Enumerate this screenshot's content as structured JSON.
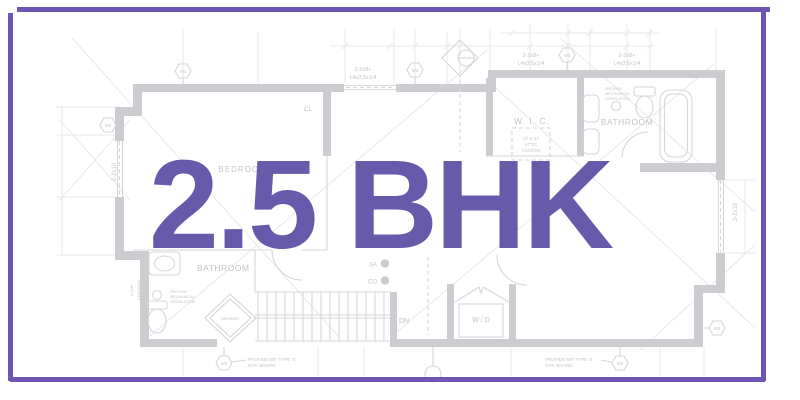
{
  "title": {
    "text": "2.5 BHK",
    "color": "#675AAB"
  },
  "frame": {
    "color": "#6F55B6"
  },
  "floor_plan": {
    "colors": {
      "wall": "#cccdd1",
      "line": "#d6d7db",
      "faint": "#e8e9ed",
      "text": "#c3c4ca"
    },
    "rooms": {
      "bedroom3": "BEDROOM 3",
      "wic": "W. I. C.",
      "bathroom_top": "BATHROOM",
      "bathroom_bottom": "BATHROOM",
      "washer_dryer": "W / D"
    },
    "labels": {
      "beam1": "2-2x8+",
      "beam2": "L4x3.5x1/4",
      "joist": "2-2x10",
      "attic1": "27 X 27",
      "attic2": "ATTIC",
      "attic3": "ACCESS",
      "vent1": "PROVIDE",
      "vent2": "MECHANICAL",
      "vent3": "VENTILATION",
      "gyp1": "PROVIDE 5/8\" TYPE 'X'",
      "gyp2": "GYP. BOARD",
      "down": "DN",
      "closet": "CL",
      "supply_air": "SA",
      "co_detector": "CO",
      "shower": "SHOWER",
      "window_tag_w3": "W3",
      "window_tag_w4": "W4"
    }
  }
}
